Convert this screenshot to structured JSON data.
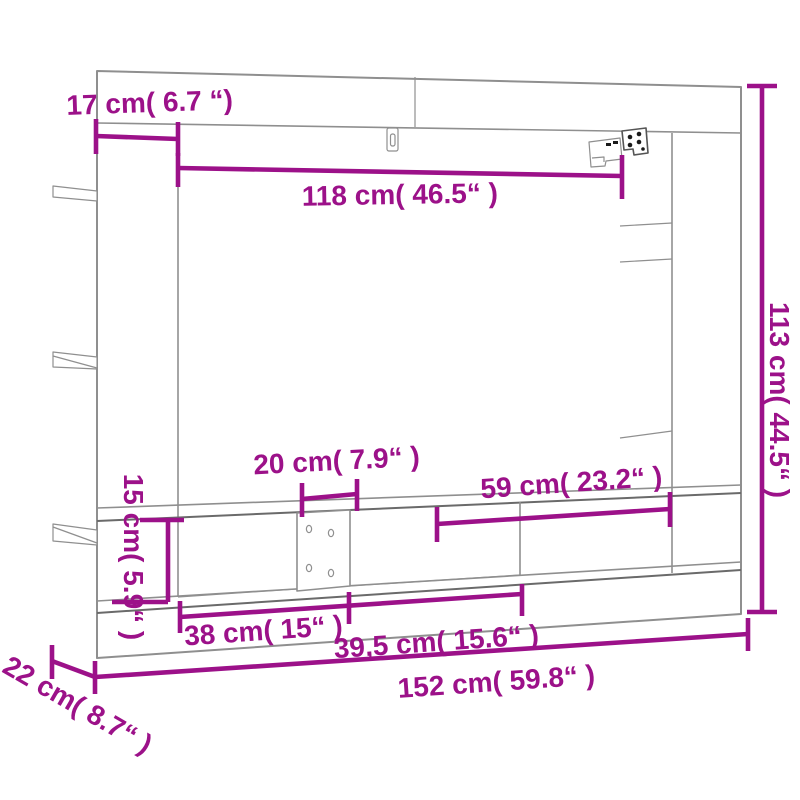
{
  "figure": {
    "type": "furniture dimension diagram",
    "subject": "wall-mounted TV cabinet technical drawing"
  },
  "style": {
    "dimension_color": "#9c1189",
    "drawing_line_color": "#8f8f8f",
    "background": "#ffffff"
  },
  "dimensions": {
    "top_depth": "17 cm( 6.7 “)",
    "tv_opening_width": "118 cm( 46.5“ )",
    "total_height": "113 cm( 44.5“ )",
    "shelf_gap_width": "20 cm( 7.9“ )",
    "right_opening_width": "59 cm( 23.2“ )",
    "lower_compartment_height": "15 cm( 5.9“ )",
    "left_compartment_width": "38 cm( 15“ )",
    "center_compartment_width": "39,5 cm( 15.6“ )",
    "total_width": "152 cm( 59.8“ )",
    "total_depth": "22 cm( 8.7“ )"
  }
}
